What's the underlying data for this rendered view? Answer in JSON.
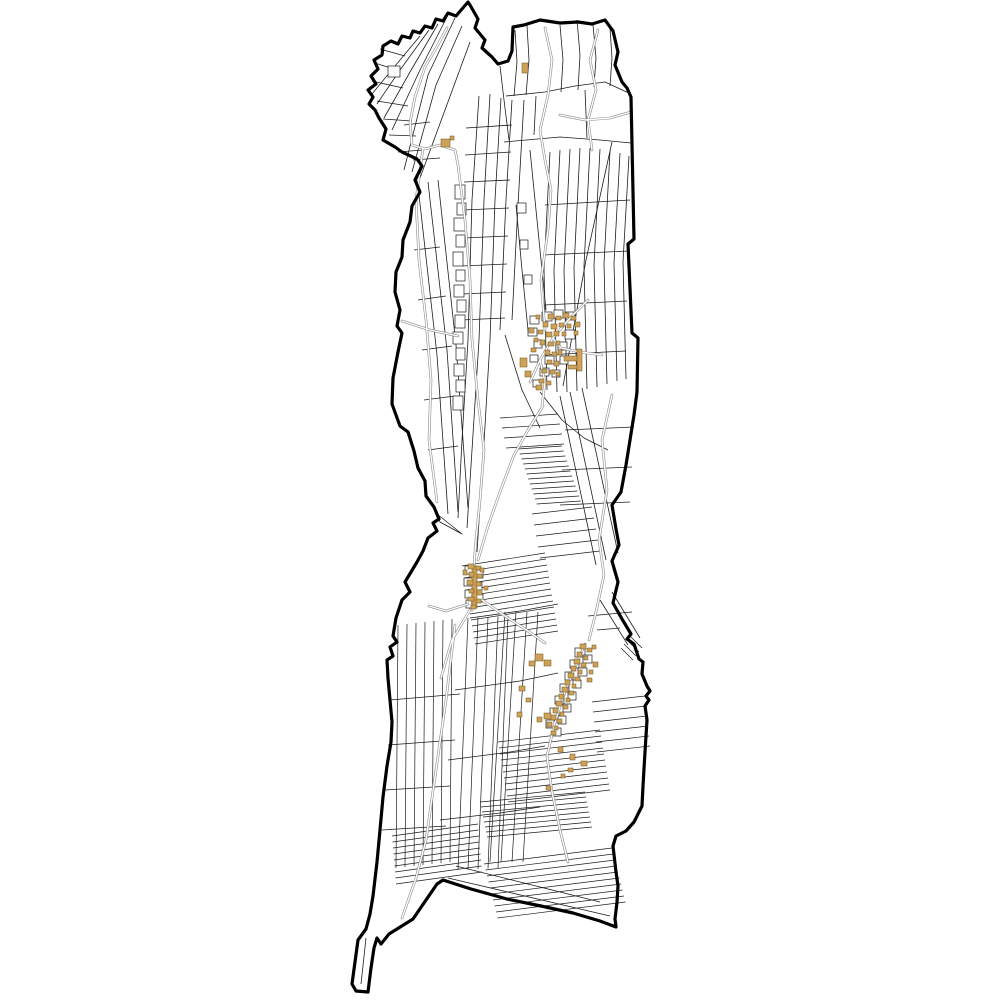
{
  "map": {
    "canvas": {
      "width": 1000,
      "height": 1000,
      "background": "#ffffff"
    },
    "styles": {
      "boundary_stroke": "#000000",
      "boundary_width": 3.2,
      "parcel_stroke": "#1c1c1c",
      "parcel_width": 0.8,
      "hatch_stroke": "#1c1c1c",
      "hatch_width": 0.7,
      "road_casing": "#8a8a8a",
      "road_casing_width": 2.6,
      "road_core": "#ffffff",
      "road_core_width": 1.4,
      "lot_fill": "#ffffff",
      "lot_stroke": "#1c1c1c",
      "lot_stroke_width": 0.7,
      "building_fill": "#cfa258",
      "building_stroke": "#6b5320",
      "building_stroke_width": 0.5
    },
    "boundary_points": "468,2 456,16 448,13 443,21 436,19 432,28 425,26 420,33 413,31 410,38 402,36 398,44 391,41 383,46 382,55 374,60 378,69 371,76 376,84 368,90 373,97 369,104 375,110 379,118 386,129 383,140 395,147 402,152 417,159 422,166 415,180 420,192 412,206 410,222 403,240 402,257 396,272 395,292 400,310 397,326 402,333 398,352 393,378 392,404 400,426 408,432 414,451 418,468 425,481 426,496 434,507 439,519 433,523 437,531 428,538 423,551 417,562 405,582 410,592 402,600 396,618 393,636 397,642 390,647 393,656 387,660 388,678 390,700 392,722 391,742 387,766 383,797 380,830 377,862 373,896 370,914 366,929 358,940 355,962 352,984 356,991 368,992 371,968 374,948 377,938 381,944 389,934 413,919 437,884 443,880 471,889 507,899 541,906 573,913 600,921 616,927 615,919 617,902 618,886 616,872 613,846 616,836 626,831 634,822 642,806 643,786 645,752 647,720 645,706 649,700 646,696 650,691 647,686 642,674 643,662 639,659 634,644 627,639 631,634 622,619 613,603 618,582 612,561 619,545 616,529 612,505 621,492 626,465 630,440 634,415 637,392 638,338 632,333 628,244 634,239 631,97 627,88 622,82 615,65 618,52 613,31 605,20 592,24 578,22 560,23 540,20 524,25 513,27 512,51 508,61 498,64 492,57 482,48 485,40 475,28 478,19 470,5",
    "parcel_polylines": [
      "455,18 428,75 404,170",
      "462,26 436,85 412,172",
      "447,17 420,70 392,130",
      "438,24 410,72 384,118",
      "429,30 400,70 377,104",
      "420,36 395,66 372,94",
      "470,42 445,110 420,178",
      "375,63 400,71",
      "372,81 403,88",
      "377,101 408,106",
      "383,119 412,121",
      "389,135 416,136",
      "380,49 405,56",
      "398,152 423,150",
      "413,160 440,158",
      "404,125 430,122",
      "500,66 504,100 509,140",
      "515,30 517,62 514,96",
      "527,25 529,60 526,95",
      "506,96 545,92 575,86 605,82 631,94",
      "504,142 560,137 600,140 631,143",
      "560,25 563,60 561,92",
      "577,20 580,55 578,90",
      "593,25 596,58 594,87",
      "610,28 612,58 610,86",
      "536,96 534,135",
      "585,90 587,138",
      "479,96 472,200 468,340 462,440 458,518",
      "490,94 484,200 479,340 472,450 467,528",
      "501,98 495,200 490,340 483,460 477,552",
      "512,100 506,200 500,330",
      "524,100 518,205 512,320",
      "466,128 512,125",
      "465,155 511,152",
      "464,182 510,180",
      "463,210 509,208",
      "463,238 508,236",
      "462,266 507,264",
      "462,294 506,292",
      "461,320 505,318",
      "550,152 544,270 547,390",
      "560,150 554,270 557,392",
      "570,149 564,270 567,392",
      "580,148 574,268 577,391",
      "590,148 584,266 587,389",
      "600,149 594,265 597,387",
      "610,151 604,264 607,384",
      "620,153 614,263 617,381",
      "629,156 623,262 626,379",
      "612,142 586,260 563,386",
      "545,205 630,200",
      "543,255 628,251",
      "544,305 627,301",
      "545,355 626,351",
      "428,182 447,350 458,512",
      "438,180 456,345 468,508",
      "419,195 437,355 448,514",
      "414,250 440,247",
      "418,300 446,296",
      "422,350 452,346",
      "424,400 455,396",
      "428,450 458,446",
      "437,514 462,534 440,522 437,514",
      "530,150 538,230 546,310",
      "516,205 522,270 528,330",
      "505,335 522,390 540,428",
      "540,392 562,420 584,438 608,450",
      "570,392 606,560",
      "560,396 596,565",
      "582,388 618,553",
      "565,430 634,427",
      "562,470 632,467",
      "560,505 630,502",
      "390,700 460,694",
      "388,745 455,740",
      "385,790 450,786",
      "382,830 446,826",
      "470,618 520,611 558,604",
      "455,690 520,681 558,673",
      "448,760 510,752 545,746",
      "440,820 500,813 540,807",
      "600,600 628,645",
      "612,592 640,638",
      "448,878 610,916",
      "456,866 600,902",
      "366,938 361,984",
      "597,630 620,628",
      "588,616 632,612"
    ],
    "hatch_bundles": [
      {
        "a": [
          518,
          449
        ],
        "b": [
          562,
          446
        ],
        "n": 12,
        "d": [
          1.7,
          5
        ]
      },
      {
        "a": [
          500,
          418
        ],
        "b": [
          558,
          414
        ],
        "n": 4,
        "d": [
          2,
          10
        ]
      },
      {
        "a": [
          532,
          514
        ],
        "b": [
          592,
          507
        ],
        "n": 5,
        "d": [
          2,
          11
        ]
      },
      {
        "a": [
          462,
          566
        ],
        "b": [
          545,
          553
        ],
        "n": 14,
        "d": [
          1,
          6
        ]
      },
      {
        "a": [
          498,
          742
        ],
        "b": [
          600,
          730
        ],
        "n": 11,
        "d": [
          1,
          6
        ]
      },
      {
        "a": [
          480,
          802
        ],
        "b": [
          585,
          792
        ],
        "n": 8,
        "d": [
          1,
          5
        ]
      },
      {
        "a": [
          392,
          836
        ],
        "b": [
          478,
          824
        ],
        "n": 9,
        "d": [
          0.5,
          6
        ]
      },
      {
        "a": [
          484,
          864
        ],
        "b": [
          612,
          848
        ],
        "n": 10,
        "d": [
          1.5,
          6
        ]
      },
      {
        "a": [
          630,
          636
        ],
        "b": [
          642,
          648
        ],
        "n": 4,
        "d": [
          -3,
          4
        ]
      },
      {
        "a": [
          592,
          702
        ],
        "b": [
          645,
          696
        ],
        "n": 6,
        "d": [
          1,
          10
        ]
      },
      {
        "a": [
          398,
          625
        ],
        "b": [
          396,
          868
        ],
        "n": 7,
        "d": [
          9,
          -1
        ]
      },
      {
        "a": [
          468,
          618
        ],
        "b": [
          458,
          870
        ],
        "n": 5,
        "d": [
          10,
          -0.5
        ]
      },
      {
        "a": [
          505,
          612
        ],
        "b": [
          490,
          862
        ],
        "n": 4,
        "d": [
          11,
          0
        ]
      }
    ],
    "lot_rects": [
      [
        455,
        185,
        10,
        14
      ],
      [
        457,
        203,
        9,
        12
      ],
      [
        454,
        218,
        11,
        13
      ],
      [
        456,
        235,
        9,
        12
      ],
      [
        453,
        252,
        10,
        14
      ],
      [
        456,
        270,
        9,
        11
      ],
      [
        454,
        285,
        10,
        12
      ],
      [
        457,
        300,
        9,
        12
      ],
      [
        455,
        315,
        10,
        13
      ],
      [
        453,
        332,
        10,
        12
      ],
      [
        456,
        348,
        9,
        12
      ],
      [
        454,
        364,
        10,
        12
      ],
      [
        456,
        380,
        9,
        12
      ],
      [
        453,
        396,
        10,
        14
      ],
      [
        388,
        66,
        12,
        11
      ],
      [
        530,
        316,
        9,
        8
      ],
      [
        542,
        312,
        10,
        9
      ],
      [
        554,
        310,
        9,
        8
      ],
      [
        566,
        312,
        9,
        8
      ],
      [
        528,
        328,
        9,
        8
      ],
      [
        565,
        330,
        10,
        9
      ],
      [
        534,
        340,
        8,
        8
      ],
      [
        558,
        342,
        9,
        8
      ],
      [
        530,
        355,
        8,
        7
      ],
      [
        545,
        356,
        9,
        8
      ],
      [
        560,
        356,
        8,
        8
      ],
      [
        540,
        368,
        9,
        8
      ],
      [
        552,
        370,
        8,
        7
      ],
      [
        533,
        380,
        8,
        7
      ],
      [
        575,
        648,
        10,
        9
      ],
      [
        583,
        655,
        9,
        8
      ],
      [
        570,
        660,
        9,
        8
      ],
      [
        578,
        668,
        9,
        8
      ],
      [
        565,
        672,
        8,
        8
      ],
      [
        573,
        680,
        8,
        8
      ],
      [
        560,
        684,
        9,
        8
      ],
      [
        568,
        692,
        8,
        8
      ],
      [
        555,
        696,
        9,
        8
      ],
      [
        563,
        704,
        8,
        8
      ],
      [
        550,
        708,
        9,
        8
      ],
      [
        558,
        716,
        8,
        8
      ],
      [
        546,
        720,
        8,
        8
      ],
      [
        553,
        728,
        8,
        8
      ],
      [
        465,
        566,
        9,
        8
      ],
      [
        474,
        570,
        9,
        8
      ],
      [
        464,
        578,
        9,
        8
      ],
      [
        473,
        582,
        9,
        8
      ],
      [
        465,
        590,
        9,
        8
      ],
      [
        474,
        594,
        9,
        8
      ],
      [
        466,
        600,
        9,
        8
      ],
      [
        517,
        203,
        9,
        10
      ],
      [
        520,
        240,
        8,
        9
      ],
      [
        524,
        275,
        8,
        9
      ]
    ],
    "roads": [
      "447,28 435,50 425,67 415,97 410,123 412,145",
      "412,145 425,149 440,145 455,150 458,165 465,220 470,280 472,340 478,400 484,450 480,500 476,540 474,565",
      "423,148 416,200 419,260 426,320 431,380 429,440 437,502",
      "545,28 552,60 548,95 540,130 545,160 551,190 548,230 541,280 545,330",
      "598,30 590,60 596,90 588,120 592,150",
      "560,115 585,120 610,118 631,112",
      "612,395 602,440 607,490 599,540 604,575 596,612 589,640",
      "588,300 570,318 553,338 540,360 530,382",
      "553,338 561,348 580,352 602,355",
      "540,360 545,382 542,406",
      "543,406 528,430 514,455 500,492 488,526 478,560",
      "482,600 505,616 525,629 545,643",
      "470,610 452,640 441,678",
      "468,604 446,611 429,606",
      "585,644 573,672 562,700 554,726 547,756 552,792 560,830 568,862",
      "402,321 430,330 458,336",
      "455,625 446,700 436,770 426,840 416,878 402,918",
      "474,565 472,610"
    ],
    "buildings": [
      [
        548,
        314,
        6,
        5
      ],
      [
        556,
        316,
        5,
        4
      ],
      [
        563,
        313,
        6,
        5
      ],
      [
        571,
        316,
        5,
        4
      ],
      [
        543,
        322,
        5,
        5
      ],
      [
        551,
        324,
        6,
        5
      ],
      [
        559,
        323,
        5,
        4
      ],
      [
        567,
        324,
        4,
        4
      ],
      [
        575,
        322,
        5,
        5
      ],
      [
        538,
        330,
        5,
        4
      ],
      [
        546,
        332,
        6,
        5
      ],
      [
        554,
        331,
        5,
        5
      ],
      [
        562,
        332,
        4,
        4
      ],
      [
        540,
        340,
        5,
        5
      ],
      [
        548,
        342,
        6,
        4
      ],
      [
        556,
        341,
        4,
        4
      ],
      [
        545,
        350,
        5,
        5
      ],
      [
        552,
        352,
        5,
        4
      ],
      [
        558,
        350,
        4,
        5
      ],
      [
        547,
        360,
        5,
        4
      ],
      [
        554,
        361,
        5,
        5
      ],
      [
        542,
        369,
        5,
        4
      ],
      [
        550,
        370,
        5,
        4
      ],
      [
        556,
        372,
        4,
        4
      ],
      [
        539,
        379,
        5,
        4
      ],
      [
        546,
        381,
        5,
        4
      ],
      [
        531,
        348,
        5,
        4
      ],
      [
        534,
        338,
        4,
        4
      ],
      [
        529,
        328,
        5,
        5
      ],
      [
        574,
        331,
        4,
        4
      ],
      [
        536,
        385,
        6,
        5
      ],
      [
        536,
        315,
        4,
        4
      ],
      [
        564,
        356,
        16,
        5
      ],
      [
        568,
        365,
        12,
        4
      ],
      [
        577,
        349,
        5,
        22
      ],
      [
        520,
        358,
        7,
        9
      ],
      [
        525,
        371,
        6,
        6
      ],
      [
        441,
        139,
        9,
        8
      ],
      [
        450,
        136,
        4,
        4
      ],
      [
        522,
        63,
        6,
        10
      ],
      [
        472,
        566,
        5,
        42
      ],
      [
        468,
        564,
        6,
        5
      ],
      [
        476,
        566,
        5,
        4
      ],
      [
        469,
        572,
        5,
        5
      ],
      [
        477,
        574,
        5,
        4
      ],
      [
        467,
        580,
        6,
        5
      ],
      [
        476,
        582,
        5,
        4
      ],
      [
        469,
        589,
        5,
        4
      ],
      [
        477,
        590,
        5,
        5
      ],
      [
        468,
        597,
        6,
        4
      ],
      [
        476,
        599,
        5,
        4
      ],
      [
        471,
        605,
        5,
        4
      ],
      [
        480,
        568,
        4,
        4
      ],
      [
        463,
        570,
        4,
        5
      ],
      [
        484,
        586,
        4,
        4
      ],
      [
        580,
        644,
        6,
        5
      ],
      [
        587,
        648,
        5,
        4
      ],
      [
        577,
        652,
        5,
        5
      ],
      [
        584,
        656,
        4,
        4
      ],
      [
        574,
        659,
        6,
        5
      ],
      [
        581,
        663,
        5,
        4
      ],
      [
        571,
        666,
        5,
        5
      ],
      [
        578,
        670,
        4,
        4
      ],
      [
        568,
        673,
        6,
        5
      ],
      [
        575,
        677,
        5,
        4
      ],
      [
        565,
        680,
        5,
        5
      ],
      [
        572,
        684,
        4,
        4
      ],
      [
        562,
        687,
        6,
        5
      ],
      [
        569,
        691,
        5,
        4
      ],
      [
        559,
        694,
        5,
        5
      ],
      [
        566,
        698,
        4,
        4
      ],
      [
        556,
        701,
        6,
        5
      ],
      [
        563,
        705,
        5,
        4
      ],
      [
        553,
        708,
        5,
        5
      ],
      [
        560,
        712,
        4,
        4
      ],
      [
        550,
        715,
        6,
        5
      ],
      [
        557,
        719,
        5,
        4
      ],
      [
        547,
        722,
        5,
        5
      ],
      [
        554,
        726,
        4,
        4
      ],
      [
        551,
        731,
        5,
        4
      ],
      [
        535,
        654,
        8,
        7
      ],
      [
        544,
        660,
        7,
        6
      ],
      [
        529,
        661,
        6,
        5
      ],
      [
        544,
        713,
        7,
        6
      ],
      [
        537,
        717,
        5,
        5
      ],
      [
        593,
        662,
        5,
        5
      ],
      [
        589,
        670,
        4,
        4
      ],
      [
        587,
        678,
        5,
        4
      ],
      [
        592,
        645,
        4,
        4
      ],
      [
        558,
        747,
        5,
        5
      ],
      [
        570,
        754,
        5,
        6
      ],
      [
        581,
        761,
        6,
        5
      ],
      [
        568,
        768,
        5,
        4
      ],
      [
        561,
        774,
        4,
        4
      ],
      [
        546,
        786,
        5,
        4
      ],
      [
        519,
        686,
        6,
        5
      ],
      [
        526,
        698,
        5,
        4
      ],
      [
        517,
        712,
        5,
        5
      ]
    ]
  }
}
